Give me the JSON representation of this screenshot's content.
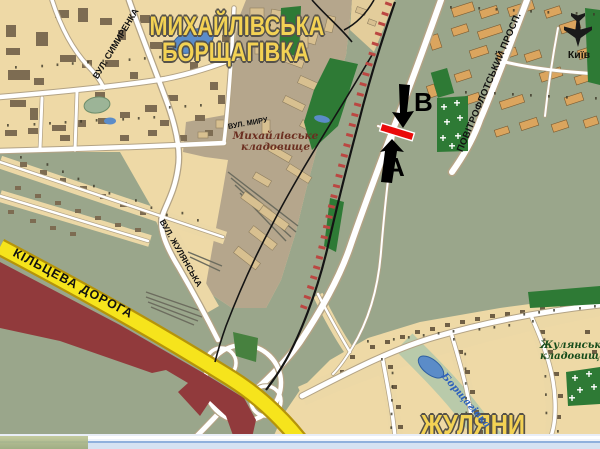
{
  "colors": {
    "background_olive": "#9aa68b",
    "residential_tan": "#eed9a6",
    "industrial_brown": "#b5a68c",
    "road_white": "#ffffff",
    "ring_road_yellow": "#f6e41c",
    "city_boundary_maroon": "#913a3c",
    "railway_black": "#141414",
    "railway_tie_red": "#bb4742",
    "park_green": "#2e7a35",
    "water_blue": "#5b8cc8",
    "settlement_title_yellow": "#f3d254",
    "route_marker_red": "#ea0a0a",
    "route_marker_black": "#000000"
  },
  "labels": {
    "settlements": {
      "mykhailivska_line1": "МИХАЙЛІВСЬКА",
      "mykhailivska_line2": "БОРЩАГІВКА",
      "zhuliany": "ЖУЛЯНИ",
      "kyiv": "Київ"
    },
    "streets": {
      "povitroflotskyi": "ПОВІТРОФЛОТСЬКИЙ ПРОСП.",
      "symyrenka": "ВУЛ. СИМИРЕНКА",
      "kiltseva": "КІЛЬЦЕВА ДОРОГА",
      "zhulianska": "ВУЛ. ЖУЛЯНСЬКА",
      "myru": "ВУЛ. МИРУ"
    },
    "places": {
      "mykhailivske_cemetery_line1": "Михайлівське",
      "mykhailivske_cemetery_line2": "кладовище",
      "zhulianske_cemetery_line1": "Жулянське",
      "zhulianske_cemetery_line2": "кладовище",
      "river": "Борщагівка"
    },
    "route_markers": {
      "a": "А",
      "b": "В"
    }
  },
  "icons": {
    "airport": "airplane-icon"
  }
}
